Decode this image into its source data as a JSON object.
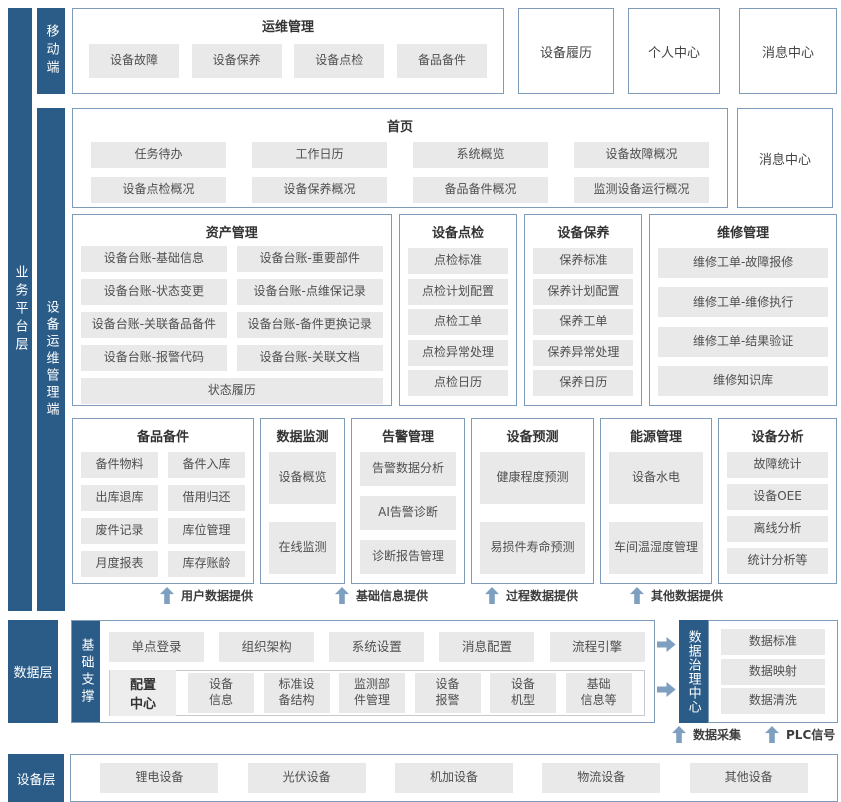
{
  "colors": {
    "primary_blue": "#2b5c88",
    "border_blue": "#7e9cba",
    "item_gray": "#e9e9e9",
    "arrow_blue": "#7e9fc0"
  },
  "business_layer": {
    "label": "业务平台层",
    "mobile": {
      "label": "移动端",
      "ops": {
        "title": "运维管理",
        "items": [
          "设备故障",
          "设备保养",
          "设备点检",
          "备品备件"
        ]
      },
      "standalone": [
        "设备履历",
        "个人中心",
        "消息中心"
      ]
    },
    "client": {
      "label": "设备运维管理端",
      "home": {
        "title": "首页",
        "items": [
          "任务待办",
          "工作日历",
          "系统概览",
          "设备故障概况",
          "设备点检概况",
          "设备保养概况",
          "备品备件概况",
          "监测设备运行概况"
        ],
        "side_box": "消息中心"
      },
      "asset": {
        "title": "资产管理",
        "items": [
          "设备台账-基础信息",
          "设备台账-重要部件",
          "设备台账-状态变更",
          "设备台账-点维保记录",
          "设备台账-关联备品备件",
          "设备台账-备件更换记录",
          "设备台账-报警代码",
          "设备台账-关联文档"
        ],
        "footer_item": "状态履历"
      },
      "inspection": {
        "title": "设备点检",
        "items": [
          "点检标准",
          "点检计划配置",
          "点检工单",
          "点检异常处理",
          "点检日历"
        ]
      },
      "upkeep": {
        "title": "设备保养",
        "items": [
          "保养标准",
          "保养计划配置",
          "保养工单",
          "保养异常处理",
          "保养日历"
        ]
      },
      "repair": {
        "title": "维修管理",
        "items": [
          "维修工单-故障报修",
          "维修工单-维修执行",
          "维修工单-结果验证",
          "维修知识库"
        ]
      },
      "spare": {
        "title": "备品备件",
        "items": [
          "备件物料",
          "备件入库",
          "出库退库",
          "借用归还",
          "废件记录",
          "库位管理",
          "月度报表",
          "库存账龄"
        ]
      },
      "monitor": {
        "title": "数据监测",
        "items": [
          "设备概览",
          "在线监测"
        ]
      },
      "alarm": {
        "title": "告警管理",
        "items": [
          "告警数据分析",
          "AI告警诊断",
          "诊断报告管理"
        ]
      },
      "predict": {
        "title": "设备预测",
        "items": [
          "健康程度预测",
          "易损件寿命预测"
        ]
      },
      "energy": {
        "title": "能源管理",
        "items": [
          "设备水电",
          "车间温湿度管理"
        ]
      },
      "analysis": {
        "title": "设备分析",
        "items": [
          "故障统计",
          "设备OEE",
          "离线分析",
          "统计分析等"
        ]
      }
    },
    "flows": [
      "用户数据提供",
      "基础信息提供",
      "过程数据提供",
      "其他数据提供"
    ]
  },
  "data_layer": {
    "label": "数据层",
    "support": {
      "label": "基础支撑",
      "row1": [
        "单点登录",
        "组织架构",
        "系统设置",
        "消息配置",
        "流程引擎"
      ],
      "config_label": "配置\n中心",
      "row2": [
        "设备\n信息",
        "标准设\n备结构",
        "监测部\n件管理",
        "设备\n报警",
        "设备\n机型",
        "基础\n信息等"
      ]
    },
    "governance": {
      "label": "数据治理中心",
      "items": [
        "数据标准",
        "数据映射",
        "数据清洗"
      ]
    },
    "collect": [
      "数据采集",
      "PLC信号"
    ]
  },
  "device_layer": {
    "label": "设备层",
    "items": [
      "锂电设备",
      "光伏设备",
      "机加设备",
      "物流设备",
      "其他设备"
    ]
  }
}
